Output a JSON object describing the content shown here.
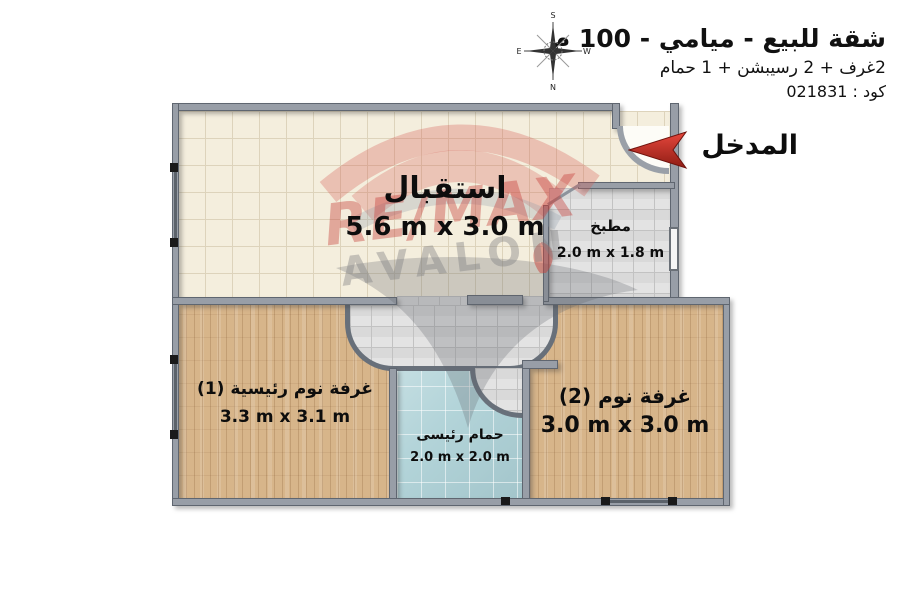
{
  "header": {
    "title": "شقة للبيع - ميامي - 100 م",
    "subtitle": "2غرف + 2 رسيبشن + 1 حمام",
    "code": "كود : 021831"
  },
  "compass": {
    "top": "S",
    "bottom": "N",
    "left": "E",
    "right": "W"
  },
  "entrance": {
    "label": "المدخل"
  },
  "watermark": {
    "brand": "RE/MAX",
    "name": "AVALON"
  },
  "rooms": {
    "reception": {
      "name": "استقبال",
      "dims": "5.6 m x 3.0 m"
    },
    "kitchen": {
      "name": "مطبخ",
      "dims": "2.0 m x 1.8 m"
    },
    "master_bedroom": {
      "name": "غرفة نوم رئيسية (1)",
      "dims": "3.3 m x 3.1 m"
    },
    "bathroom": {
      "name": "حمام رئيسى",
      "dims": "2.0 m x 2.0 m"
    },
    "bedroom2": {
      "name": "غرفة نوم (2)",
      "dims": "3.0 m x 3.0 m"
    }
  },
  "colors": {
    "accent_red": "#d23b33",
    "wall_grey": "#989ea7",
    "wood": "#d7b58a",
    "cream_tile": "#f4eedd",
    "grey_tile": "#d9d9d9",
    "blue_tile": "#b3d4d9"
  }
}
